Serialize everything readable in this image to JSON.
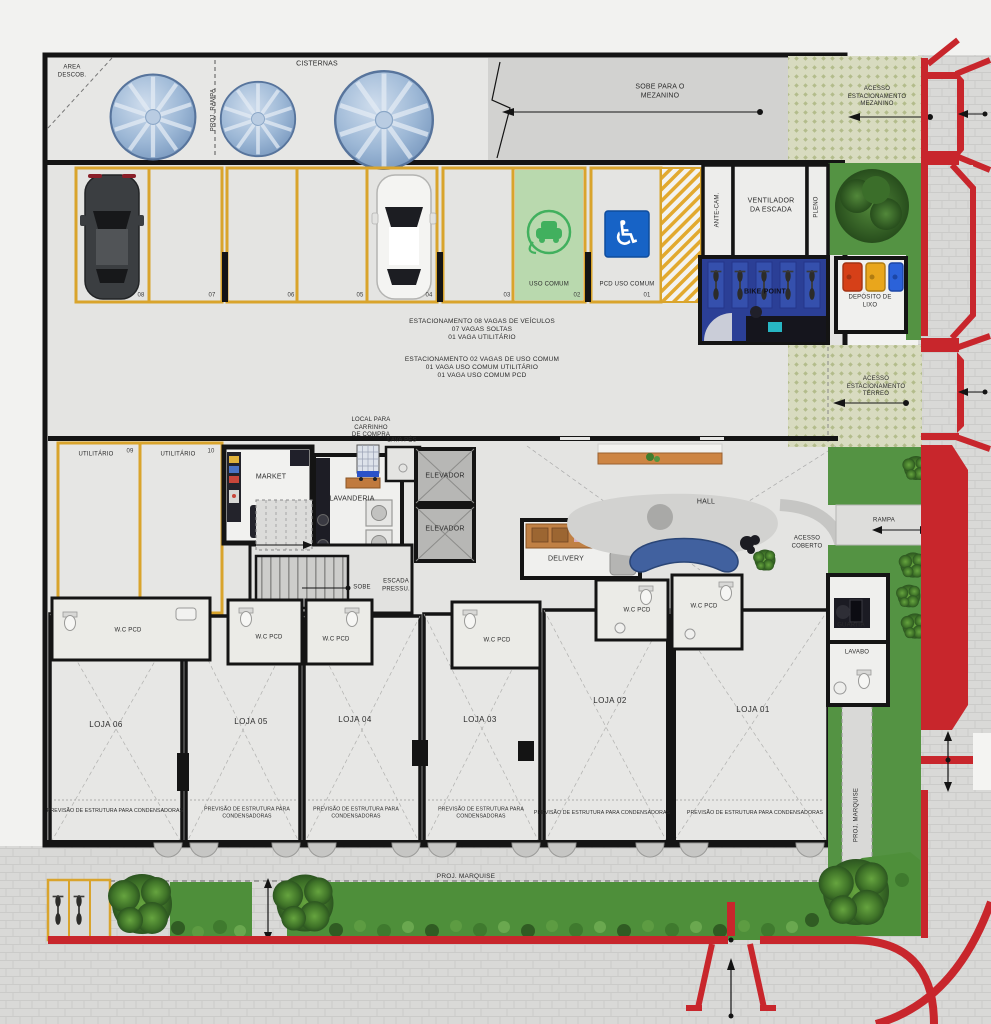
{
  "exterior_top": {
    "area_descob": "AREA\nDESCOB.",
    "proj_rampa": "PROJ. RAMPA",
    "cisternas": "CISTERNAS",
    "sobe_para_o_mezanino": "SOBE PARA O\nMEZANINO",
    "acesso_estacionamento_mezanino": "ACESSO\nESTACIONAMENTO\nMEZANINO"
  },
  "parking": {
    "stalls": [
      "08",
      "07",
      "06",
      "05",
      "04",
      "03",
      "02",
      "01"
    ],
    "uso_comum": "USO COMUM",
    "pcd_uso_comum": "PCD USO COMUM",
    "summary_1": "ESTACIONAMENTO 08 VAGAS DE VEÍCULOS\n07 VAGAS SOLTAS\n01 VAGA UTILITÁRIO",
    "summary_2": "ESTACIONAMENTO 02 VAGAS DE USO COMUM\n01 VAGA USO COMUM UTILITÁRIO\n01 VAGA USO COMUM PCD",
    "acesso_estacionamento_terreo": "ACESSO\nESTACIONAMENTO\nTÉRREO",
    "utilitario": "UTILITÁRIO",
    "utilitario_09": "09",
    "utilitario_10": "10"
  },
  "rooms": {
    "ante_cam": "ANTE-CAM.",
    "ventilador_da_escada": "VENTILADOR\nDA ESCADA",
    "pleno": "PLENO",
    "bike_point": "BIKE POINT",
    "deposito_de_lixo": "DEPÓSITO DE\nLIXO",
    "market": "MARKET",
    "lavanderia": "LAVANDERIA",
    "local_para_carrinho": "LOCAL PARA\nCARRINHO\nDE COMPRA",
    "lava_pes": "LAVA PÉS",
    "elevador": "ELEVADOR",
    "sobe": "SOBE",
    "escada_pressu": "ESCADA\nPRESSU.",
    "delivery": "DELIVERY",
    "hall": "HALL",
    "acesso_coberto": "ACESSO\nCOBERTO",
    "rampa": "RAMPA",
    "guarita": "GUARITA",
    "lavabo": "LAVABO",
    "wc_pcd": "W.C PCD"
  },
  "lojas": [
    {
      "name": "LOJA 06",
      "note": "PREVISÃO DE ESTRUTURA PARA CONDENSADORAS"
    },
    {
      "name": "LOJA 05",
      "note": "PREVISÃO DE ESTRUTURA PARA\nCONDENSADORAS"
    },
    {
      "name": "LOJA 04",
      "note": "PREVISÃO DE ESTRUTURA PARA\nCONDENSADORAS"
    },
    {
      "name": "LOJA 03",
      "note": "PREVISÃO DE ESTRUTURA PARA\nCONDENSADORAS"
    },
    {
      "name": "LOJA 02",
      "note": "PREVISÃO DE ESTRUTURA PARA CONDENSADORAS"
    },
    {
      "name": "LOJA 01",
      "note": "PREVISÃO DE ESTRUTURA PARA CONDENSADORAS"
    }
  ],
  "exterior_bottom": {
    "proj_marquise": "PROJ. MARQUISE"
  },
  "exterior_right": {
    "proj_marquise_vertical": "PROJ. MARQUISE"
  },
  "colors": {
    "stall_line": "#d9a42c",
    "curb_red": "#c8262c",
    "grass": "#549343",
    "bike_point_blue": "#2b3f96",
    "pcd_blue": "#1763c6",
    "ev_green": "#41b05e",
    "uso_comum_fill": "#b9d9ae",
    "wall": "#141414"
  }
}
